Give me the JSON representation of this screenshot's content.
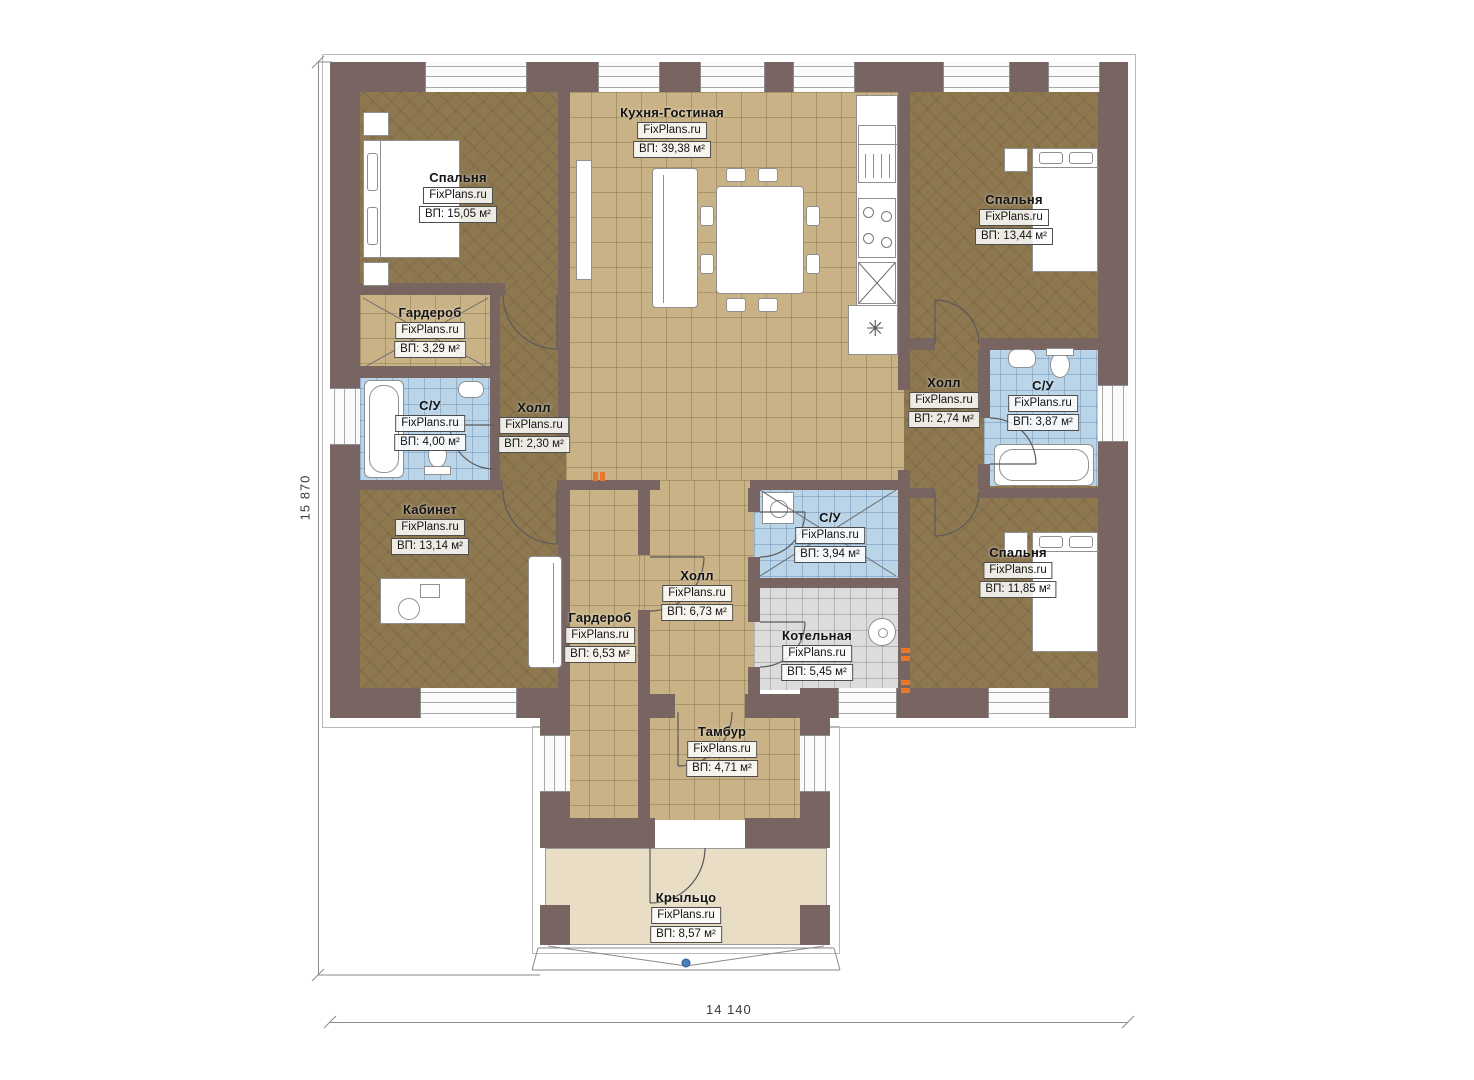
{
  "plan": {
    "watermark": "FixPlans.ru",
    "dimensions": {
      "height_label": "15 870",
      "width_label": "14 140"
    },
    "rooms": [
      {
        "name": "Спальня",
        "watermark": "FixPlans.ru",
        "area": "ВП: 15,05 м²"
      },
      {
        "name": "Кухня-Гостиная",
        "watermark": "FixPlans.ru",
        "area": "ВП: 39,38 м²"
      },
      {
        "name": "Спальня",
        "watermark": "FixPlans.ru",
        "area": "ВП: 13,44 м²"
      },
      {
        "name": "Гардероб",
        "watermark": "FixPlans.ru",
        "area": "ВП: 3,29 м²"
      },
      {
        "name": "С/У",
        "watermark": "FixPlans.ru",
        "area": "ВП: 4,00 м²"
      },
      {
        "name": "Холл",
        "watermark": "FixPlans.ru",
        "area": "ВП: 2,30 м²"
      },
      {
        "name": "Холл",
        "watermark": "FixPlans.ru",
        "area": "ВП: 2,74 м²"
      },
      {
        "name": "С/У",
        "watermark": "FixPlans.ru",
        "area": "ВП: 3,87 м²"
      },
      {
        "name": "Кабинет",
        "watermark": "FixPlans.ru",
        "area": "ВП: 13,14 м²"
      },
      {
        "name": "Холл",
        "watermark": "FixPlans.ru",
        "area": "ВП: 6,73 м²"
      },
      {
        "name": "С/У",
        "watermark": "FixPlans.ru",
        "area": "ВП: 3,94 м²"
      },
      {
        "name": "Гардероб",
        "watermark": "FixPlans.ru",
        "area": "ВП: 6,53 м²"
      },
      {
        "name": "Котельная",
        "watermark": "FixPlans.ru",
        "area": "ВП: 5,45 м²"
      },
      {
        "name": "Спальня",
        "watermark": "FixPlans.ru",
        "area": "ВП: 11,85 м²"
      },
      {
        "name": "Тамбур",
        "watermark": "FixPlans.ru",
        "area": "ВП: 4,71 м²"
      },
      {
        "name": "Крыльцо",
        "watermark": "FixPlans.ru",
        "area": "ВП: 8,57 м²"
      }
    ]
  },
  "colors": {
    "wall": "#786461",
    "bedroom_floor": "#8e7850",
    "tile_floor": "#c9b285",
    "bath_floor": "#bad4e8",
    "boiler_floor": "#dcdcdc",
    "porch_floor": "#e9ddc6",
    "accent_orange": "#e8762b",
    "marker_blue": "#4a7fb5"
  }
}
